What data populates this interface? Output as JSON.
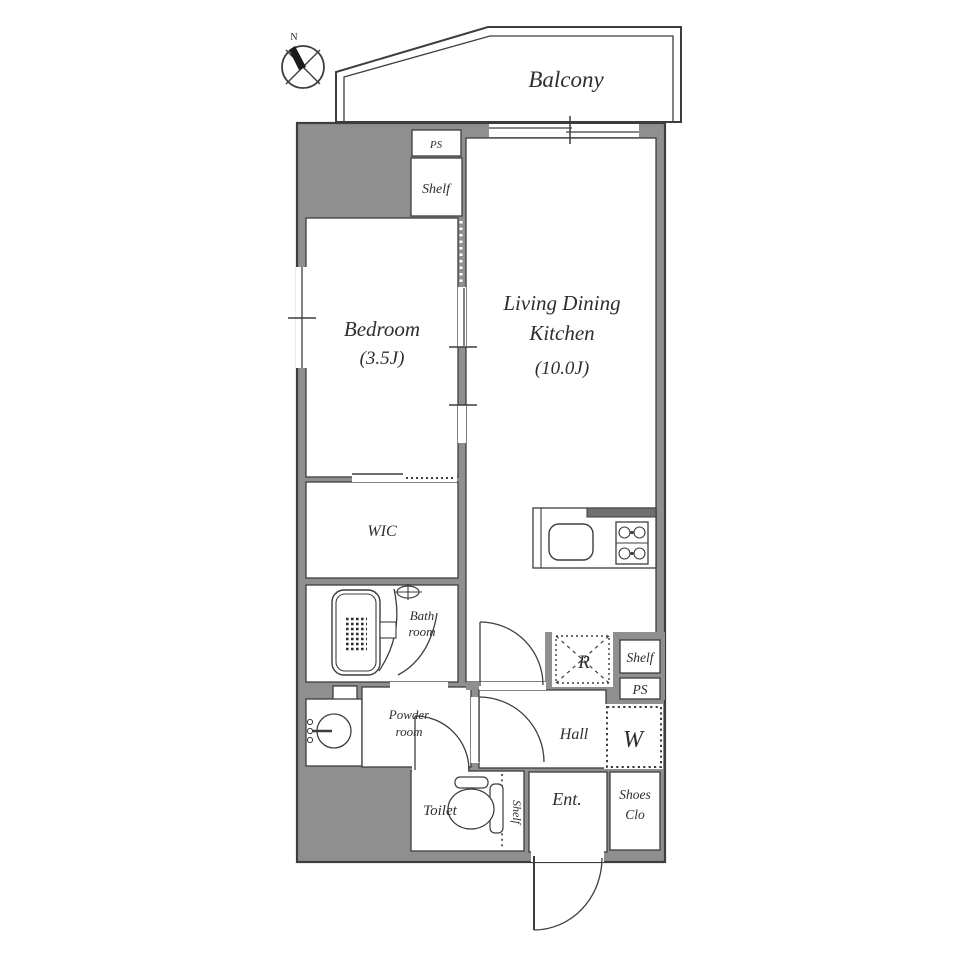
{
  "title": "Apartment floor plan 1LDK",
  "labels": {
    "compass_n": "N",
    "balcony": "Balcony",
    "ps_top": "PS",
    "shelf_top": "Shelf",
    "bedroom_name": "Bedroom",
    "bedroom_area": "(3.5J)",
    "ldk_line1": "Living Dining",
    "ldk_line2": "Kitchen",
    "ldk_area": "(10.0J)",
    "wic": "WIC",
    "bath_line1": "Bath",
    "bath_line2": "room",
    "powder_line1": "Powder",
    "powder_line2": "room",
    "hall": "Hall",
    "refrigerator": "R",
    "shelf_right": "Shelf",
    "ps_right": "PS",
    "washer": "W",
    "toilet": "Toilet",
    "toilet_shelf": "Shelf",
    "entrance": "Ent.",
    "shoes_line1": "Shoes",
    "shoes_line2": "Clo"
  },
  "colors": {
    "wall_fill": "#8f8f8f",
    "line": "#3d3d3d",
    "counter_bar": "#707070",
    "room_fill": "#ffffff",
    "text": "#2e2e2e"
  }
}
